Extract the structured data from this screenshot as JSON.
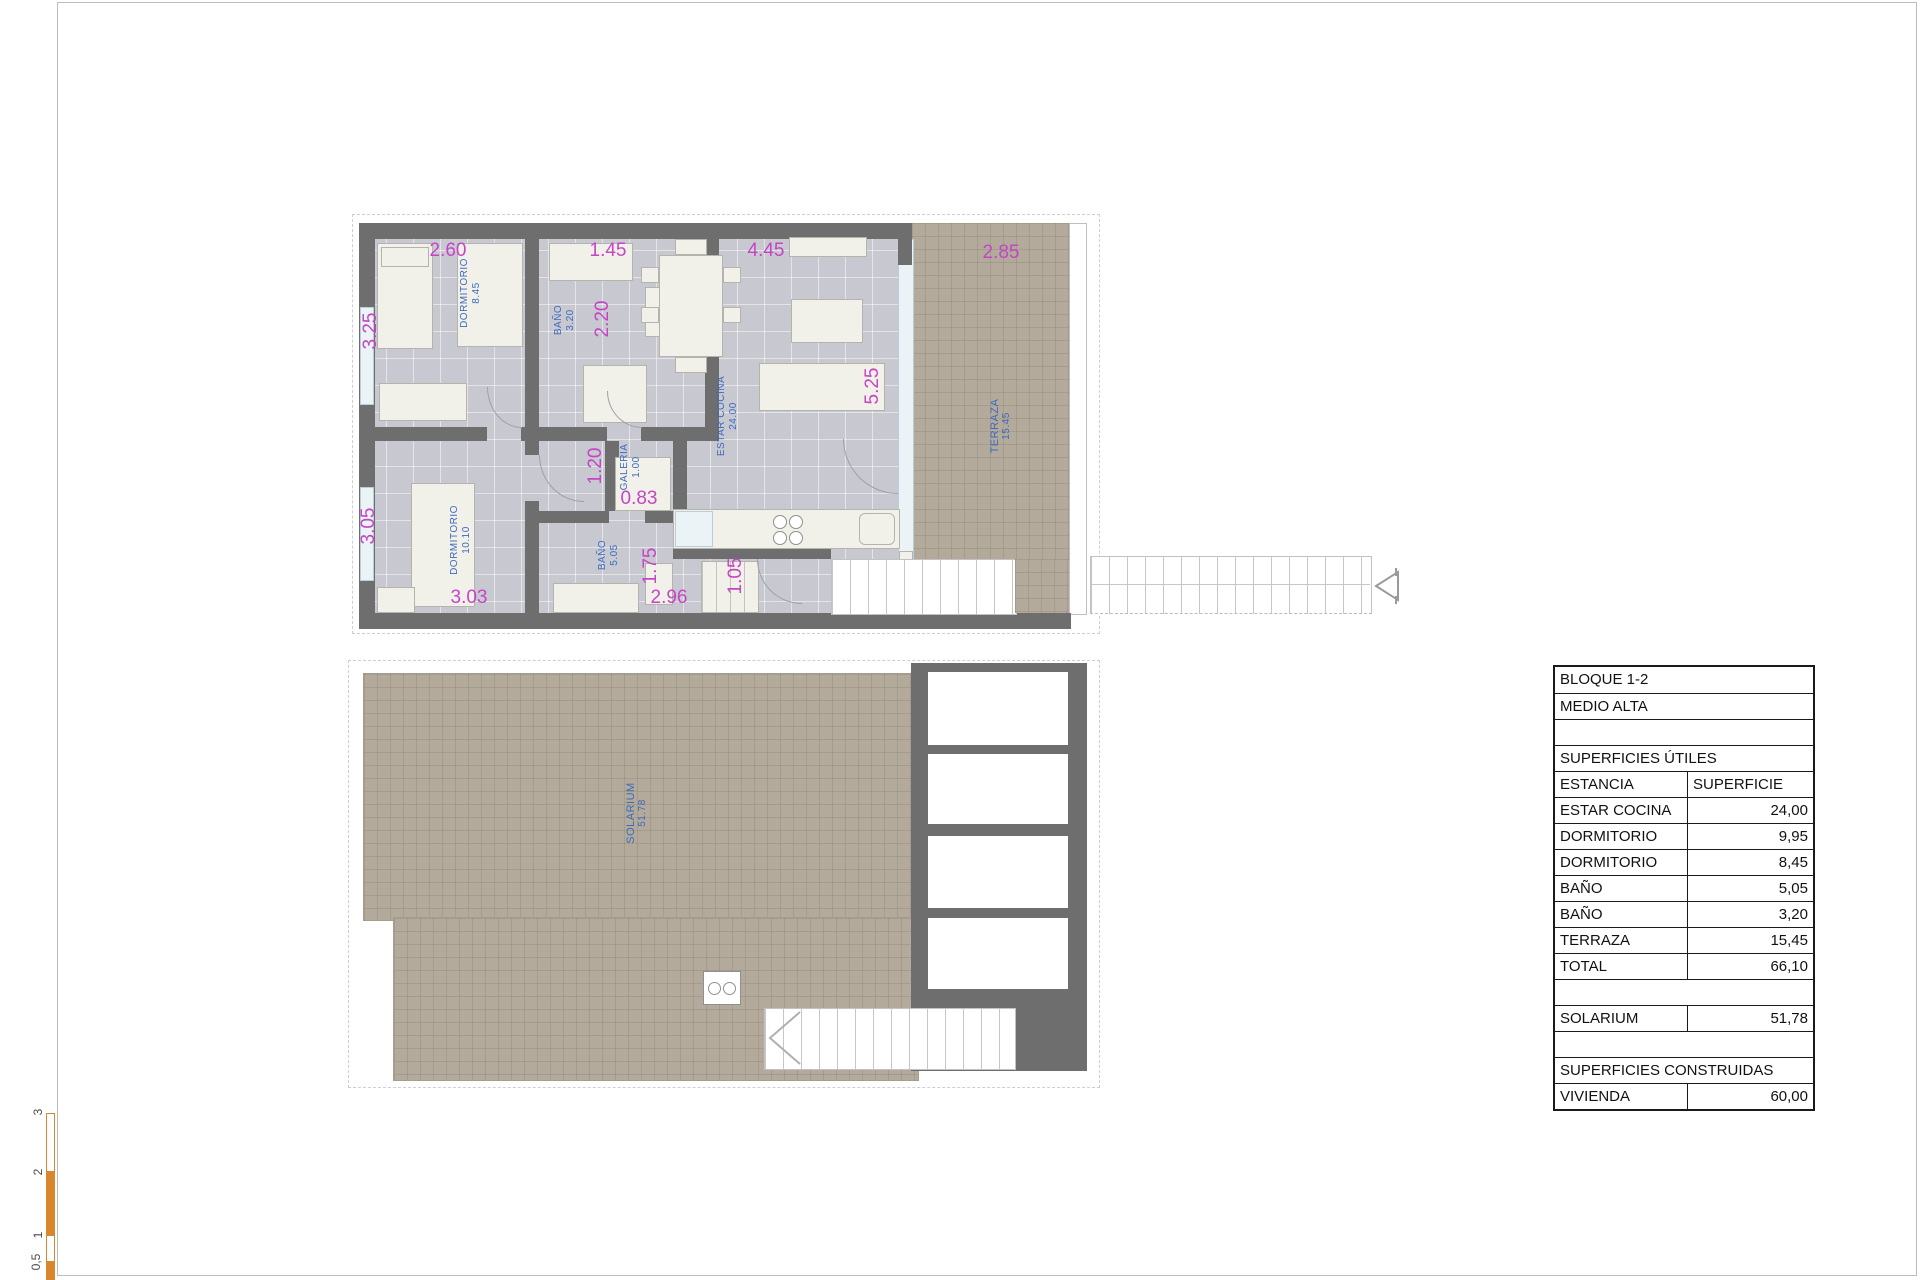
{
  "document": {
    "type": "floor-plan-sheet",
    "colors": {
      "wall": "#6e6e6e",
      "floor": "#c8c8d0",
      "tile": "#b3aa9b",
      "dimension_text": "#c545c5",
      "room_label_text": "#3a6abf",
      "scale_bar": "#d9862c"
    }
  },
  "upper_plan": {
    "rooms": {
      "dorm1": {
        "name": "DORMITORIO",
        "area": "8.45"
      },
      "bano1": {
        "name": "BAÑO",
        "area": "3.20"
      },
      "estar": {
        "name": "ESTAR COCINA",
        "area": "24.00"
      },
      "galeria": {
        "name": "GALERIA",
        "area": "1.00"
      },
      "dorm2": {
        "name": "DORMITORIO",
        "area": "10.10"
      },
      "bano2": {
        "name": "BAÑO",
        "area": "5.05"
      },
      "terraza": {
        "name": "TERRAZA",
        "area": "15.45"
      }
    },
    "dims": {
      "dorm1_width": "2.60",
      "bano1_width": "1.45",
      "estar_width": "4.45",
      "terraza_width": "2.85",
      "dorm1_height": "3.25",
      "bano1_height": "2.20",
      "estar_height": "5.25",
      "dorm2_height": "3.05",
      "galeria_height": "1.20",
      "galeria_width": "0.83",
      "bano2_height": "1.75",
      "closet_width": "1.05",
      "dorm2_width": "3.03",
      "bano2_width": "2.96"
    }
  },
  "lower_plan": {
    "solarium": {
      "name": "SOLARIUM",
      "area": "51.78"
    }
  },
  "table": {
    "rows": [
      {
        "label": "BLOQUE 1-2",
        "value": null,
        "merged": true
      },
      {
        "label": "MEDIO ALTA",
        "value": null,
        "merged": true
      },
      {
        "label": "",
        "value": null,
        "merged": true
      },
      {
        "label": "SUPERFICIES ÚTILES",
        "value": null,
        "merged": true
      },
      {
        "label": "ESTANCIA",
        "value": "SUPERFICIE"
      },
      {
        "label": "ESTAR COCINA",
        "value": "24,00"
      },
      {
        "label": "DORMITORIO",
        "value": "9,95"
      },
      {
        "label": "DORMITORIO",
        "value": "8,45"
      },
      {
        "label": "BAÑO",
        "value": "5,05"
      },
      {
        "label": "BAÑO",
        "value": "3,20"
      },
      {
        "label": "TERRAZA",
        "value": "15,45"
      },
      {
        "label": "TOTAL",
        "value": "66,10"
      },
      {
        "label": "",
        "value": null,
        "merged": true
      },
      {
        "label": "SOLARIUM",
        "value": "51,78"
      },
      {
        "label": "",
        "value": null,
        "merged": true
      },
      {
        "label": "SUPERFICIES CONSTRUIDAS",
        "value": null,
        "merged": true
      },
      {
        "label": "VIVIENDA",
        "value": "60,00"
      }
    ]
  },
  "scale_bar": {
    "labels": [
      "3",
      "2",
      "1",
      "0,5"
    ]
  }
}
